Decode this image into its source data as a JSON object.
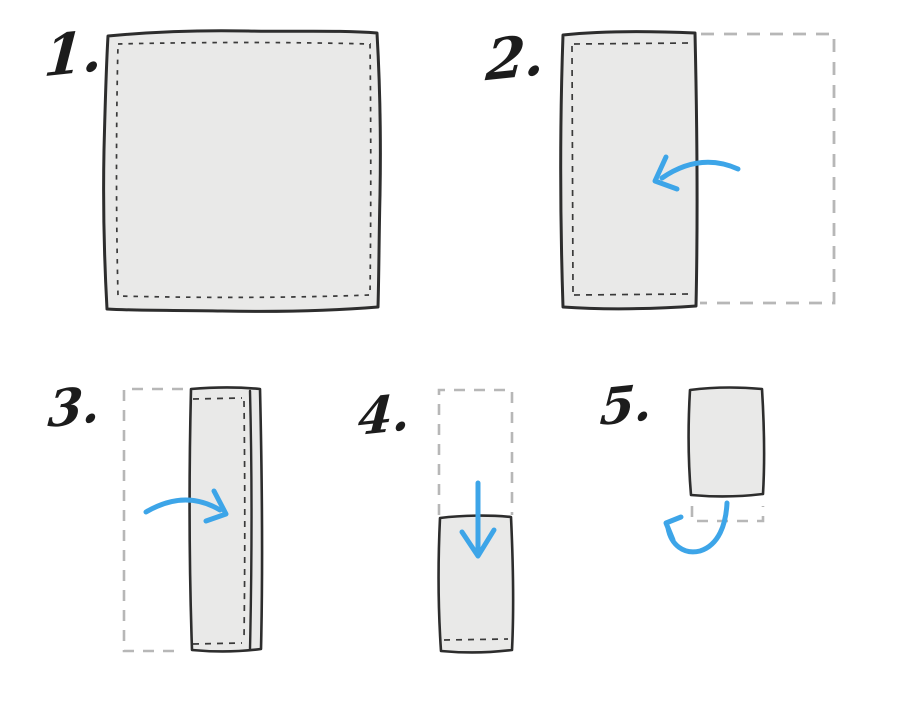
{
  "diagram": {
    "kind": "napkin-folding-instructions",
    "background": "white",
    "steps": [
      {
        "label": "1.",
        "figure": "flat-square-cloth-with-stitched-hem"
      },
      {
        "label": "2.",
        "figure": "right-half-folded-onto-left-half",
        "arrow": "curved-arrow-pointing-left"
      },
      {
        "label": "3.",
        "figure": "left-half-folded-onto-right-half",
        "arrow": "curved-arrow-pointing-right"
      },
      {
        "label": "4.",
        "figure": "top-half-folded-down",
        "arrow": "straight-arrow-pointing-down"
      },
      {
        "label": "5.",
        "figure": "final-folded-rectangle-tucked-under",
        "arrow": "curved-arrow-sweeping-up-left"
      }
    ]
  },
  "colors": {
    "background": "#ffffff",
    "ink": "#1c1c1c",
    "outline": "#2d2d2d",
    "stitch": "#3a3a3a",
    "fabric_fill": "#e9e9e8",
    "ghost_outline": "#b7b7b7",
    "accent_blue": "#3da5e8"
  }
}
